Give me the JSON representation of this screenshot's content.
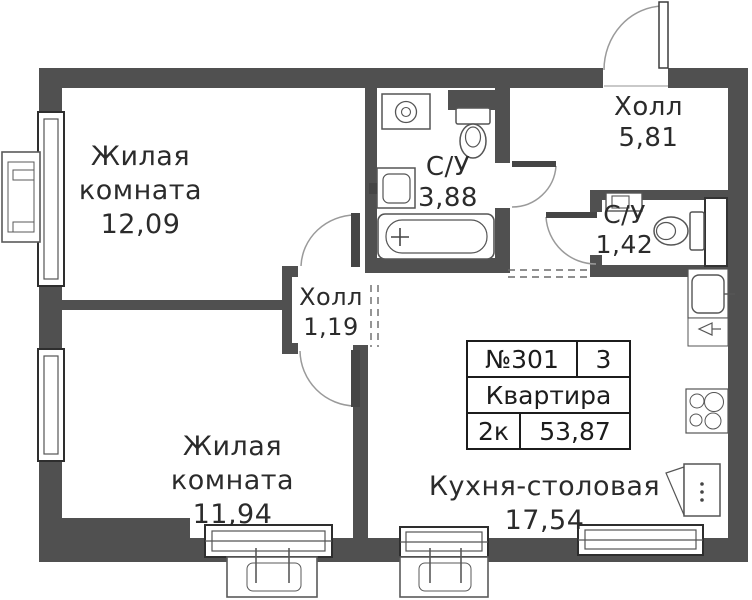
{
  "plan": {
    "rooms": [
      {
        "id": "living-1",
        "name": "Жилая комната",
        "area": "12,09"
      },
      {
        "id": "hall-main",
        "name": "Холл",
        "area": "5,81"
      },
      {
        "id": "bathroom-1",
        "name": "С/У",
        "area": "3,88"
      },
      {
        "id": "bathroom-2",
        "name": "С/У",
        "area": "1,42"
      },
      {
        "id": "hall-small",
        "name": "Холл",
        "area": "1,19"
      },
      {
        "id": "living-2",
        "name": "Жилая комната",
        "area": "11,94"
      },
      {
        "id": "kitchen",
        "name": "Кухня-столовая",
        "area": "17,54"
      }
    ],
    "info_table": {
      "apartment_number": "№301",
      "floor": "3",
      "type_label": "Квартира",
      "rooms_count": "2к",
      "total_area": "53,87"
    },
    "colors": {
      "wall": "#505050",
      "line": "#2b2b2b",
      "fixture_stroke": "#555555",
      "background": "#ffffff"
    }
  }
}
